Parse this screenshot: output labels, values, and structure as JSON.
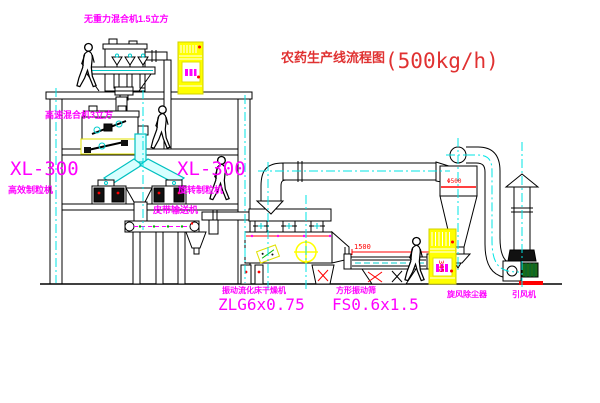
{
  "title": {
    "cn": "农药生产线流程图",
    "capacity": "(500kg/h)"
  },
  "labels": {
    "mixer_top": "无重力混合机1.5立方",
    "mixer_2f": "高速混合机3立方",
    "granulator_left_model": "XL-300",
    "granulator_left_name": "高效制粒机",
    "granulator_mid_model": "XL-300",
    "granulator_mid_name": "旋转制粒机",
    "belt_conveyor": "皮带输送机",
    "dryer_name": "振动流化床干燥机",
    "dryer_model": "ZLG6x0.75",
    "sieve_name": "方形振动筛",
    "sieve_model": "FS0.6x1.5",
    "cyclone": "旋风除尘器",
    "fan": "引风机"
  },
  "dimensions": {
    "sieve_length": "1500",
    "sieve_height": "345",
    "cyclone_note": "Φ500"
  },
  "colors": {
    "magenta": "#ff00ff",
    "red": "#ff0000",
    "yellow": "#ffff00",
    "cyan": "#00ffff",
    "green": "#00b400",
    "line": "#000000",
    "title_red": "#e03232"
  }
}
